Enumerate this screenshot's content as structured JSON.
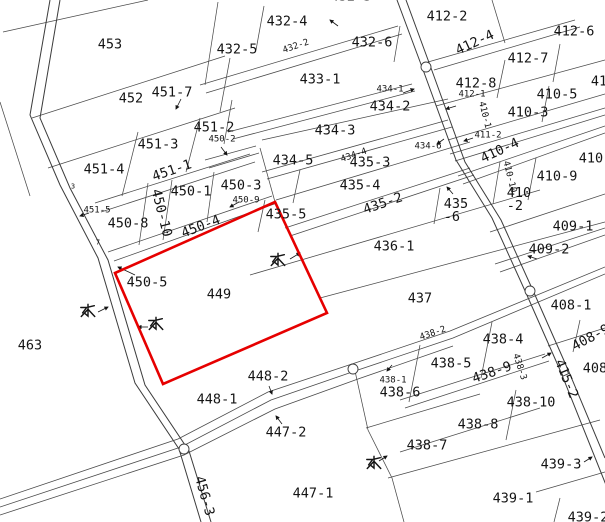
{
  "map": {
    "type": "cadastral-parcel-map",
    "selected_parcel": "449",
    "highlight_color": "#e60000",
    "line_color": "#4a4a4a",
    "road_color": "#3c3c3c",
    "background": "#ffffff",
    "parcel_labels": [
      {
        "text": "453",
        "x": 110,
        "y": 45,
        "rot": 0,
        "size": "l"
      },
      {
        "text": "452",
        "x": 131,
        "y": 99,
        "rot": 0,
        "size": "l"
      },
      {
        "text": "451-7",
        "x": 172,
        "y": 93,
        "rot": 0,
        "size": "l"
      },
      {
        "text": "451-2",
        "x": 214,
        "y": 128,
        "rot": 0,
        "size": "l"
      },
      {
        "text": "451-3",
        "x": 158,
        "y": 145,
        "rot": 0,
        "size": "l"
      },
      {
        "text": "451-4",
        "x": 104,
        "y": 170,
        "rot": 0,
        "size": "l"
      },
      {
        "text": "451-1",
        "x": 172,
        "y": 171,
        "rot": -19,
        "size": "l"
      },
      {
        "text": "451-5",
        "x": 97,
        "y": 211,
        "rot": 0,
        "size": "s"
      },
      {
        "text": "450-1",
        "x": 191,
        "y": 192,
        "rot": 0,
        "size": "l"
      },
      {
        "text": "450-2",
        "x": 222,
        "y": 140,
        "rot": 0,
        "size": "s"
      },
      {
        "text": "450-3",
        "x": 241,
        "y": 186,
        "rot": 0,
        "size": "l"
      },
      {
        "text": "450-9",
        "x": 246,
        "y": 201,
        "rot": 0,
        "size": "s"
      },
      {
        "text": "450-8",
        "x": 128,
        "y": 224,
        "rot": 0,
        "size": "l"
      },
      {
        "text": "450-10",
        "x": 161,
        "y": 213,
        "rot": 76,
        "size": "l"
      },
      {
        "text": "450-4",
        "x": 201,
        "y": 227,
        "rot": -21,
        "size": "l"
      },
      {
        "text": "450-5",
        "x": 147,
        "y": 283,
        "rot": 0,
        "size": "l"
      },
      {
        "text": "449",
        "x": 219,
        "y": 295,
        "rot": 0,
        "size": "l"
      },
      {
        "text": "463",
        "x": 30,
        "y": 346,
        "rot": 0,
        "size": "l"
      },
      {
        "text": "448-2",
        "x": 268,
        "y": 377,
        "rot": 0,
        "size": "l"
      },
      {
        "text": "448-1",
        "x": 217,
        "y": 400,
        "rot": 0,
        "size": "l"
      },
      {
        "text": "447-2",
        "x": 286,
        "y": 433,
        "rot": 0,
        "size": "l"
      },
      {
        "text": "447-1",
        "x": 313,
        "y": 494,
        "rot": 0,
        "size": "l"
      },
      {
        "text": "456-3",
        "x": 204,
        "y": 496,
        "rot": 74,
        "size": "l"
      },
      {
        "text": "432-3",
        "x": 351,
        "y": -3,
        "rot": 0,
        "size": "l"
      },
      {
        "text": "432-4",
        "x": 287,
        "y": 22,
        "rot": 0,
        "size": "l"
      },
      {
        "text": "432-5",
        "x": 237,
        "y": 50,
        "rot": 0,
        "size": "l"
      },
      {
        "text": "432-2",
        "x": 296,
        "y": 47,
        "rot": -19,
        "size": "s"
      },
      {
        "text": "432-6",
        "x": 372,
        "y": 43,
        "rot": 0,
        "size": "l"
      },
      {
        "text": "433-1",
        "x": 320,
        "y": 80,
        "rot": 0,
        "size": "l"
      },
      {
        "text": "434-1",
        "x": 390,
        "y": 90,
        "rot": 0,
        "size": "s"
      },
      {
        "text": "434-2",
        "x": 390,
        "y": 107,
        "rot": 0,
        "size": "l"
      },
      {
        "text": "434-3",
        "x": 335,
        "y": 131,
        "rot": 0,
        "size": "l"
      },
      {
        "text": "434-5",
        "x": 293,
        "y": 161,
        "rot": 0,
        "size": "l"
      },
      {
        "text": "434-4",
        "x": 354,
        "y": 156,
        "rot": -19,
        "size": "s"
      },
      {
        "text": "434-6",
        "x": 428,
        "y": 147,
        "rot": 0,
        "size": "s"
      },
      {
        "text": "435-3",
        "x": 370,
        "y": 163,
        "rot": 0,
        "size": "l"
      },
      {
        "text": "435-4",
        "x": 360,
        "y": 186,
        "rot": 0,
        "size": "l"
      },
      {
        "text": "435-2",
        "x": 383,
        "y": 204,
        "rot": -19,
        "size": "l"
      },
      {
        "text": "435-5",
        "x": 286,
        "y": 215,
        "rot": 0,
        "size": "l"
      },
      {
        "text": "435\n-6",
        "x": 456,
        "y": 211,
        "rot": 0,
        "size": "l"
      },
      {
        "text": "436-1",
        "x": 394,
        "y": 247,
        "rot": 0,
        "size": "l"
      },
      {
        "text": "437",
        "x": 420,
        "y": 299,
        "rot": 0,
        "size": "l"
      },
      {
        "text": "412-2",
        "x": 447,
        "y": 17,
        "rot": 0,
        "size": "l"
      },
      {
        "text": "412-4",
        "x": 475,
        "y": 43,
        "rot": -25,
        "size": "l"
      },
      {
        "text": "412-6",
        "x": 574,
        "y": 32,
        "rot": 0,
        "size": "l"
      },
      {
        "text": "412-7",
        "x": 528,
        "y": 59,
        "rot": 0,
        "size": "l"
      },
      {
        "text": "412-8",
        "x": 476,
        "y": 84,
        "rot": 0,
        "size": "l"
      },
      {
        "text": "412-1",
        "x": 472,
        "y": 95,
        "rot": 0,
        "size": "s"
      },
      {
        "text": "410-1",
        "x": 484,
        "y": 115,
        "rot": 76,
        "size": "s"
      },
      {
        "text": "410-3",
        "x": 528,
        "y": 113,
        "rot": 0,
        "size": "l"
      },
      {
        "text": "410-5",
        "x": 557,
        "y": 95,
        "rot": 0,
        "size": "l"
      },
      {
        "text": "41",
        "x": 599,
        "y": 82,
        "rot": 0,
        "size": "l"
      },
      {
        "text": "411-2",
        "x": 488,
        "y": 136,
        "rot": 0,
        "size": "s"
      },
      {
        "text": "410-4",
        "x": 500,
        "y": 151,
        "rot": -25,
        "size": "l"
      },
      {
        "text": "410-",
        "x": 595,
        "y": 159,
        "rot": 0,
        "size": "l"
      },
      {
        "text": "410-9",
        "x": 557,
        "y": 177,
        "rot": 0,
        "size": "l"
      },
      {
        "text": "410-10",
        "x": 509,
        "y": 177,
        "rot": 76,
        "size": "s"
      },
      {
        "text": "410\n-2",
        "x": 519,
        "y": 200,
        "rot": 0,
        "size": "l"
      },
      {
        "text": "409-1",
        "x": 573,
        "y": 227,
        "rot": 0,
        "size": "l"
      },
      {
        "text": "409-2",
        "x": 549,
        "y": 250,
        "rot": 0,
        "size": "l"
      },
      {
        "text": "408-1",
        "x": 571,
        "y": 306,
        "rot": 0,
        "size": "l"
      },
      {
        "text": "408-9",
        "x": 591,
        "y": 338,
        "rot": -28,
        "size": "l"
      },
      {
        "text": "408",
        "x": 595,
        "y": 369,
        "rot": 0,
        "size": "l"
      },
      {
        "text": "415-2",
        "x": 566,
        "y": 379,
        "rot": 68,
        "size": "l"
      },
      {
        "text": "438-2",
        "x": 433,
        "y": 334,
        "rot": -19,
        "size": "s"
      },
      {
        "text": "438-4",
        "x": 503,
        "y": 340,
        "rot": 0,
        "size": "l"
      },
      {
        "text": "438-5",
        "x": 451,
        "y": 364,
        "rot": 0,
        "size": "l"
      },
      {
        "text": "438-9",
        "x": 492,
        "y": 373,
        "rot": -19,
        "size": "l"
      },
      {
        "text": "438-3",
        "x": 519,
        "y": 367,
        "rot": 72,
        "size": "s"
      },
      {
        "text": "438-1",
        "x": 393,
        "y": 381,
        "rot": 0,
        "size": "s"
      },
      {
        "text": "438-6",
        "x": 400,
        "y": 393,
        "rot": 0,
        "size": "l"
      },
      {
        "text": "438-10",
        "x": 531,
        "y": 403,
        "rot": 0,
        "size": "l"
      },
      {
        "text": "438-8",
        "x": 478,
        "y": 425,
        "rot": 0,
        "size": "l"
      },
      {
        "text": "438-7",
        "x": 427,
        "y": 446,
        "rot": 0,
        "size": "l"
      },
      {
        "text": "439-3",
        "x": 561,
        "y": 465,
        "rot": 0,
        "size": "l"
      },
      {
        "text": "439-1",
        "x": 513,
        "y": 499,
        "rot": 0,
        "size": "l"
      },
      {
        "text": "439-2",
        "x": 588,
        "y": 518,
        "rot": 0,
        "size": "l"
      },
      {
        "text": "3",
        "x": 73,
        "y": 187,
        "rot": 0,
        "size": "t"
      },
      {
        "text": "7",
        "x": 98,
        "y": 243,
        "rot": 0,
        "size": "t"
      }
    ],
    "water_marks": {
      "glyph": "水",
      "points": [
        {
          "x": 88,
          "y": 312
        },
        {
          "x": 156,
          "y": 325
        },
        {
          "x": 278,
          "y": 261
        },
        {
          "x": 374,
          "y": 464
        }
      ]
    }
  }
}
